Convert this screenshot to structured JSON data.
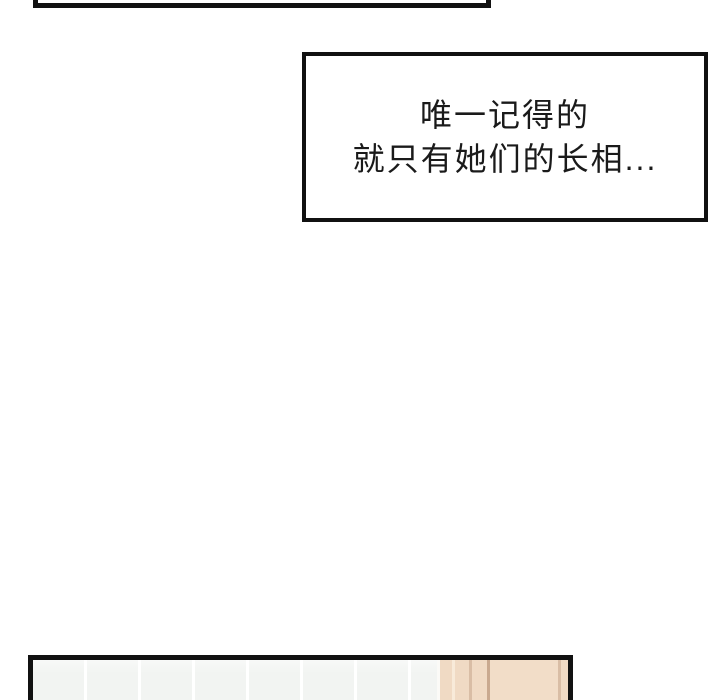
{
  "caption": {
    "lines": {
      "0": "唯一记得的",
      "1": "就只有她们的长相..."
    }
  },
  "colors": {
    "page_bg": "#ffffff",
    "border_color": "#111111",
    "tile_color": "#f2f4f2",
    "tile_gap_color": "#ffffff",
    "wall_beige": "#f0dac4",
    "wall_panel": "#f2ddc8",
    "wall_line_light": "#f8ead9",
    "wall_line_mid": "#d9bda5",
    "wall_line_dark": "#c9a98f"
  }
}
